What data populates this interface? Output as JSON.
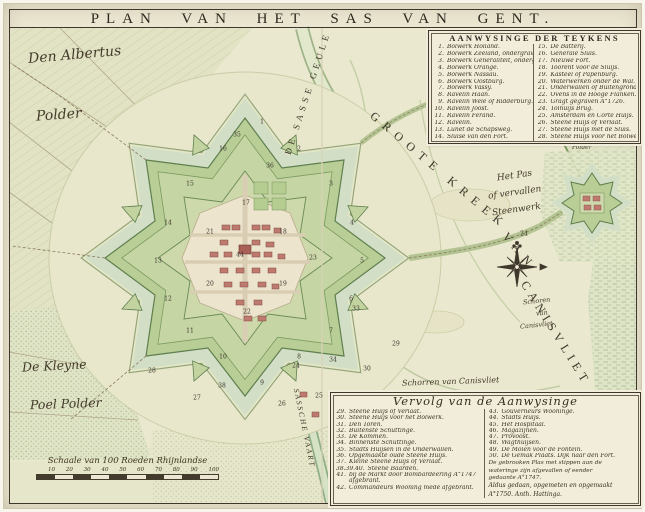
{
  "title": "PLAN VAN HET SAS VAN GENT.",
  "legend_top": {
    "header": "AANWYSINGE DER TEYKENS",
    "col1": [
      {
        "n": "1.",
        "t": "Bolwerk Holland."
      },
      {
        "n": "2.",
        "t": "Bolwerk Zeeland, ondergraven."
      },
      {
        "n": "3.",
        "t": "Bolwerk Generaliteit, onderg."
      },
      {
        "n": "4.",
        "t": "Bolwerk Orange."
      },
      {
        "n": "5.",
        "t": "Bolwerk Nassau."
      },
      {
        "n": "6.",
        "t": "Bolwerk Oostburg."
      },
      {
        "n": "7.",
        "t": "Bolwerk Vassy."
      },
      {
        "n": "8.",
        "t": "Ravelin Haan."
      },
      {
        "n": "9.",
        "t": "Ravelin Wele of Ridderburg."
      },
      {
        "n": "10.",
        "t": "Ravelin Joost."
      },
      {
        "n": "11.",
        "t": "Ravelin Ferand."
      },
      {
        "n": "12.",
        "t": "Ravelin."
      },
      {
        "n": "13.",
        "t": "Lunet de Schapsweg."
      },
      {
        "n": "14.",
        "t": "Sluise van den Fort."
      }
    ],
    "col2": [
      {
        "n": "15.",
        "t": "De Batterij."
      },
      {
        "n": "16.",
        "t": "Generale Sluis."
      },
      {
        "n": "17.",
        "t": "Nieuwe Fort."
      },
      {
        "n": "18.",
        "t": "Toorent voor de Sluijs."
      },
      {
        "n": "19.",
        "t": "Kasteel of Papenburg."
      },
      {
        "n": "20.",
        "t": "Waterwerken onder de Wal."
      },
      {
        "n": "21.",
        "t": "Onderwallen of Buitengrond."
      },
      {
        "n": "22.",
        "t": "Ovens in de Hooge Flanken."
      },
      {
        "n": "23.",
        "t": "Gragt gegraven A°1726."
      },
      {
        "n": "24.",
        "t": "Tolhuijs Brug."
      },
      {
        "n": "25.",
        "t": "Amsterdam en Corte Huijs."
      },
      {
        "n": "26.",
        "t": "Steene Huijs of Verlaat."
      },
      {
        "n": "27.",
        "t": "Steene Huijs met de Sluis."
      },
      {
        "n": "28.",
        "t": "Steene Huijs voor het Bolwerk."
      }
    ]
  },
  "legend_bottom": {
    "header": "Vervolg van de Aanwysinge",
    "col1": [
      {
        "n": "29.",
        "t": "Steene Huijs of Verlaat."
      },
      {
        "n": "30.",
        "t": "Steene Huijs voor het Bolwerk."
      },
      {
        "n": "31.",
        "t": "Den Toren."
      },
      {
        "n": "32.",
        "t": "Buitenste Schuttinge."
      },
      {
        "n": "33.",
        "t": "De Kommen."
      },
      {
        "n": "34.",
        "t": "Binnenste Schuttinge."
      },
      {
        "n": "35.",
        "t": "Stadts Huijsen in de Onderwallen."
      },
      {
        "n": "36.",
        "t": "Opgemaakte oude Steene Huijs."
      },
      {
        "n": "37.",
        "t": "Kleine Steene Huijs of Verlaat."
      },
      {
        "n": "38.39.40.",
        "t": "Steene Baarden."
      },
      {
        "n": "41.",
        "t": "bij de Markt door Bombardeering A°1747 afgebrant."
      },
      {
        "n": "42.",
        "t": "Commandeurs Wooning mede afgebrant."
      }
    ],
    "col2": [
      {
        "n": "43.",
        "t": "Gouverneurs Wooninge."
      },
      {
        "n": "44.",
        "t": "Stadts Huijs."
      },
      {
        "n": "45.",
        "t": "Het Hospitaal."
      },
      {
        "n": "46.",
        "t": "Magazijnen."
      },
      {
        "n": "47.",
        "t": "Provoost."
      },
      {
        "n": "48.",
        "t": "Wagthuijsen."
      },
      {
        "n": "49.",
        "t": "De Molen voor de Fontein."
      },
      {
        "n": "50.",
        "t": "De Gemak Plaats. Dijk naar den Fort."
      }
    ],
    "note_lines": [
      "De gebrooken Plas met stippen aan de",
      "wateringe zijn afgevallen of eender",
      "gedaante A°1747."
    ],
    "signature_lines": [
      "Aldus gedaan, opgemeten en opgemaakt",
      "A°1750. Anth. Hattinga."
    ]
  },
  "labels": {
    "polder_nw_1": "Den Albertus",
    "polder_nw_2": "Polder",
    "polder_sw_1": "De Kleyne",
    "polder_sw_2": "Poel Polder",
    "het_pas_1": "Het Pas",
    "het_pas_2": "of vervallen",
    "het_pas_3": "Steenwerk",
    "schoren_1": "Schoren",
    "schoren_2": "van",
    "schoren_3": "Canisvliet",
    "polder_ne_1": "Auwrijk",
    "polder_ne_2": "Polder",
    "schorren_mid": "Schorren van Canisvliet",
    "schorren_s_1": "Schorren van St.",
    "schorren_s_2": "Anthoni Polder",
    "geule": "DE SASSE GEULE",
    "kreek_1": "GROOTE KREEK",
    "kreek_2": "VAN",
    "kreek_3": "CANISVLIET",
    "vaart": "SASSCHE VAART"
  },
  "scalebar": {
    "caption": "Schaale van 100 Roeden Rhijnlandse",
    "ticks": [
      "10",
      "20",
      "30",
      "40",
      "50",
      "60",
      "70",
      "80",
      "90",
      "100"
    ]
  },
  "markers": [
    {
      "n": "1",
      "x": 262,
      "y": 122
    },
    {
      "n": "2",
      "x": 299,
      "y": 149
    },
    {
      "n": "3",
      "x": 331,
      "y": 184
    },
    {
      "n": "4",
      "x": 352,
      "y": 223
    },
    {
      "n": "5",
      "x": 362,
      "y": 261
    },
    {
      "n": "6",
      "x": 351,
      "y": 299
    },
    {
      "n": "7",
      "x": 331,
      "y": 331
    },
    {
      "n": "8",
      "x": 299,
      "y": 357
    },
    {
      "n": "9",
      "x": 262,
      "y": 383
    },
    {
      "n": "10",
      "x": 223,
      "y": 357
    },
    {
      "n": "11",
      "x": 190,
      "y": 331
    },
    {
      "n": "12",
      "x": 168,
      "y": 299
    },
    {
      "n": "13",
      "x": 158,
      "y": 261
    },
    {
      "n": "14",
      "x": 168,
      "y": 223
    },
    {
      "n": "15",
      "x": 190,
      "y": 184
    },
    {
      "n": "16",
      "x": 223,
      "y": 149
    },
    {
      "n": "17",
      "x": 246,
      "y": 203
    },
    {
      "n": "18",
      "x": 283,
      "y": 232
    },
    {
      "n": "19",
      "x": 283,
      "y": 284
    },
    {
      "n": "20",
      "x": 210,
      "y": 284
    },
    {
      "n": "21",
      "x": 210,
      "y": 232
    },
    {
      "n": "22",
      "x": 247,
      "y": 312
    },
    {
      "n": "23",
      "x": 313,
      "y": 258
    },
    {
      "n": "24",
      "x": 296,
      "y": 366
    },
    {
      "n": "25",
      "x": 319,
      "y": 396
    },
    {
      "n": "26",
      "x": 282,
      "y": 404
    },
    {
      "n": "27",
      "x": 197,
      "y": 398
    },
    {
      "n": "28",
      "x": 152,
      "y": 371
    },
    {
      "n": "29",
      "x": 396,
      "y": 344
    },
    {
      "n": "30",
      "x": 367,
      "y": 369
    },
    {
      "n": "31",
      "x": 338,
      "y": 394
    },
    {
      "n": "33",
      "x": 356,
      "y": 309
    },
    {
      "n": "34",
      "x": 333,
      "y": 360
    },
    {
      "n": "35",
      "x": 237,
      "y": 135
    },
    {
      "n": "36",
      "x": 270,
      "y": 166
    },
    {
      "n": "38",
      "x": 222,
      "y": 386
    },
    {
      "n": "44",
      "x": 240,
      "y": 255
    },
    {
      "n": "24",
      "x": 524,
      "y": 234
    }
  ],
  "colors": {
    "paper": "#ece7d2",
    "ink": "#3f372c",
    "rampart_green": "#b9cd96",
    "moat_water": "#d2dfc6",
    "building_red": "#bf7a70",
    "field_green": "#e2e3c4",
    "creek": "#eae8ce"
  }
}
